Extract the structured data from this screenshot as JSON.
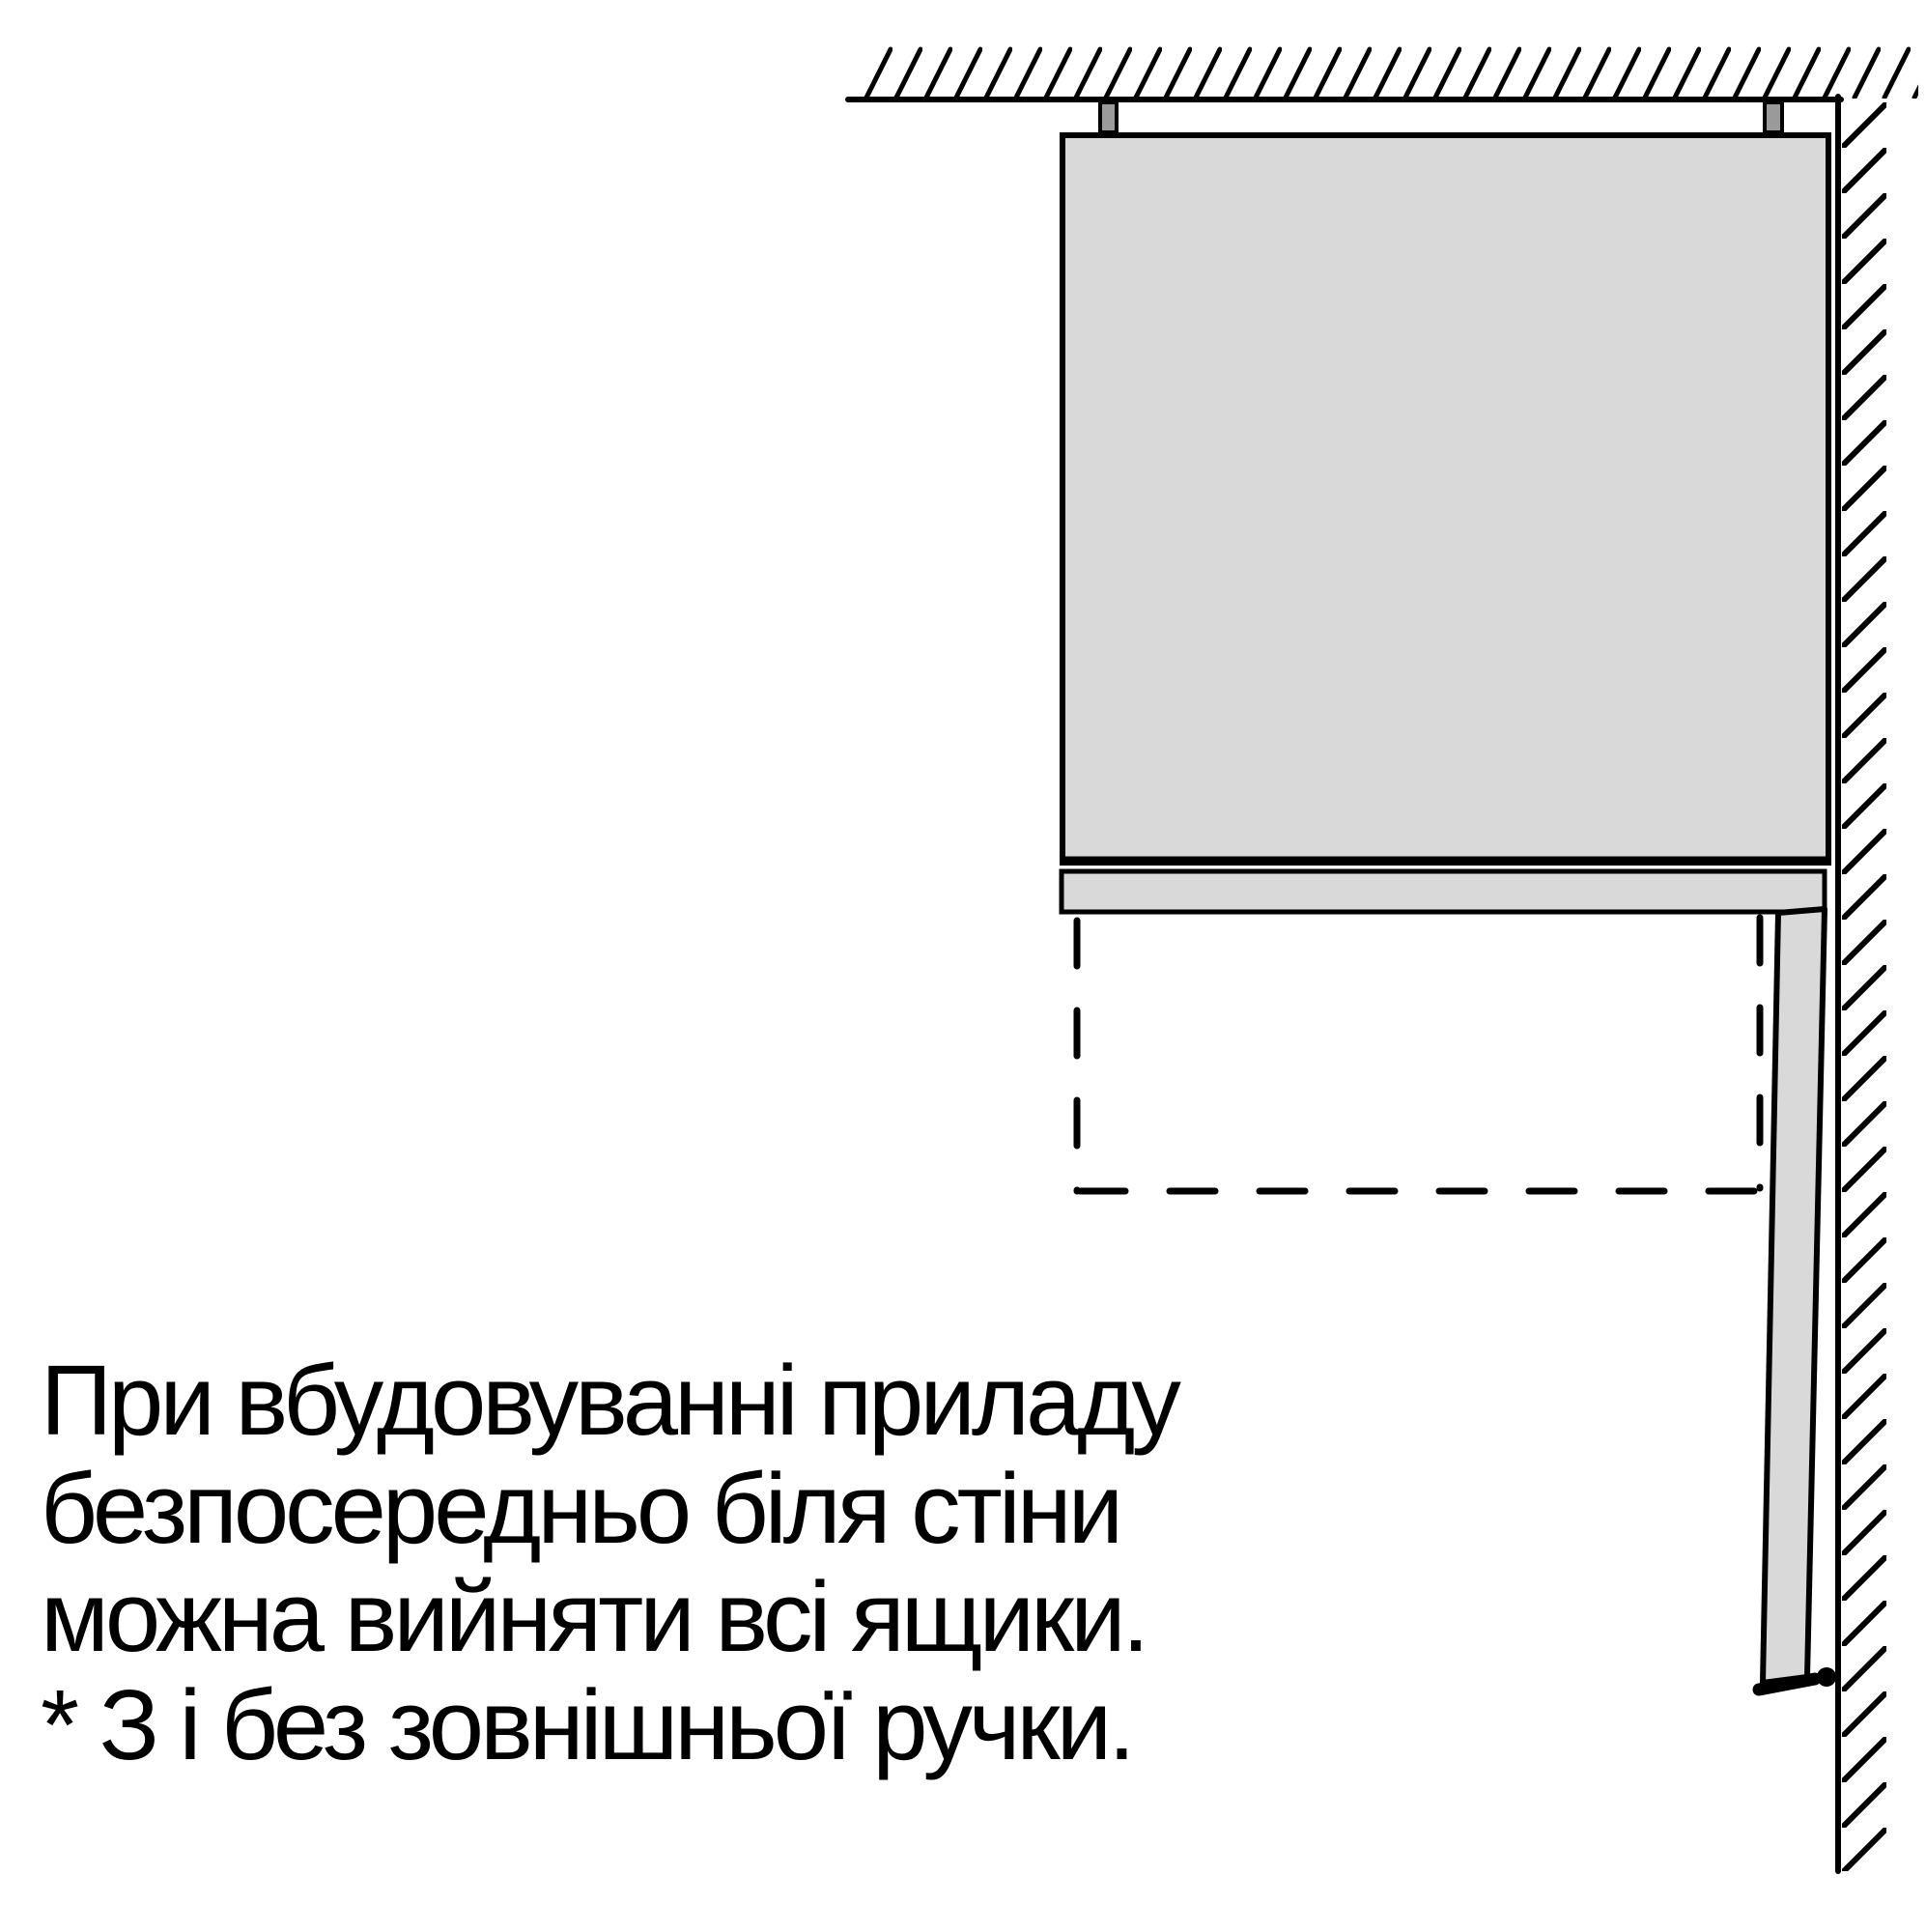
{
  "diagram": {
    "caption_lines": [
      "При вбудовуванні приладу",
      "безпосередньо біля стіни",
      "можна вийняти всі ящики.",
      "* З і без зовнішньої ручки."
    ],
    "colors": {
      "background": "#ffffff",
      "outline": "#000000",
      "appliance_fill": "#d9d9d9",
      "bracket_fill": "#9a9a9a"
    }
  }
}
